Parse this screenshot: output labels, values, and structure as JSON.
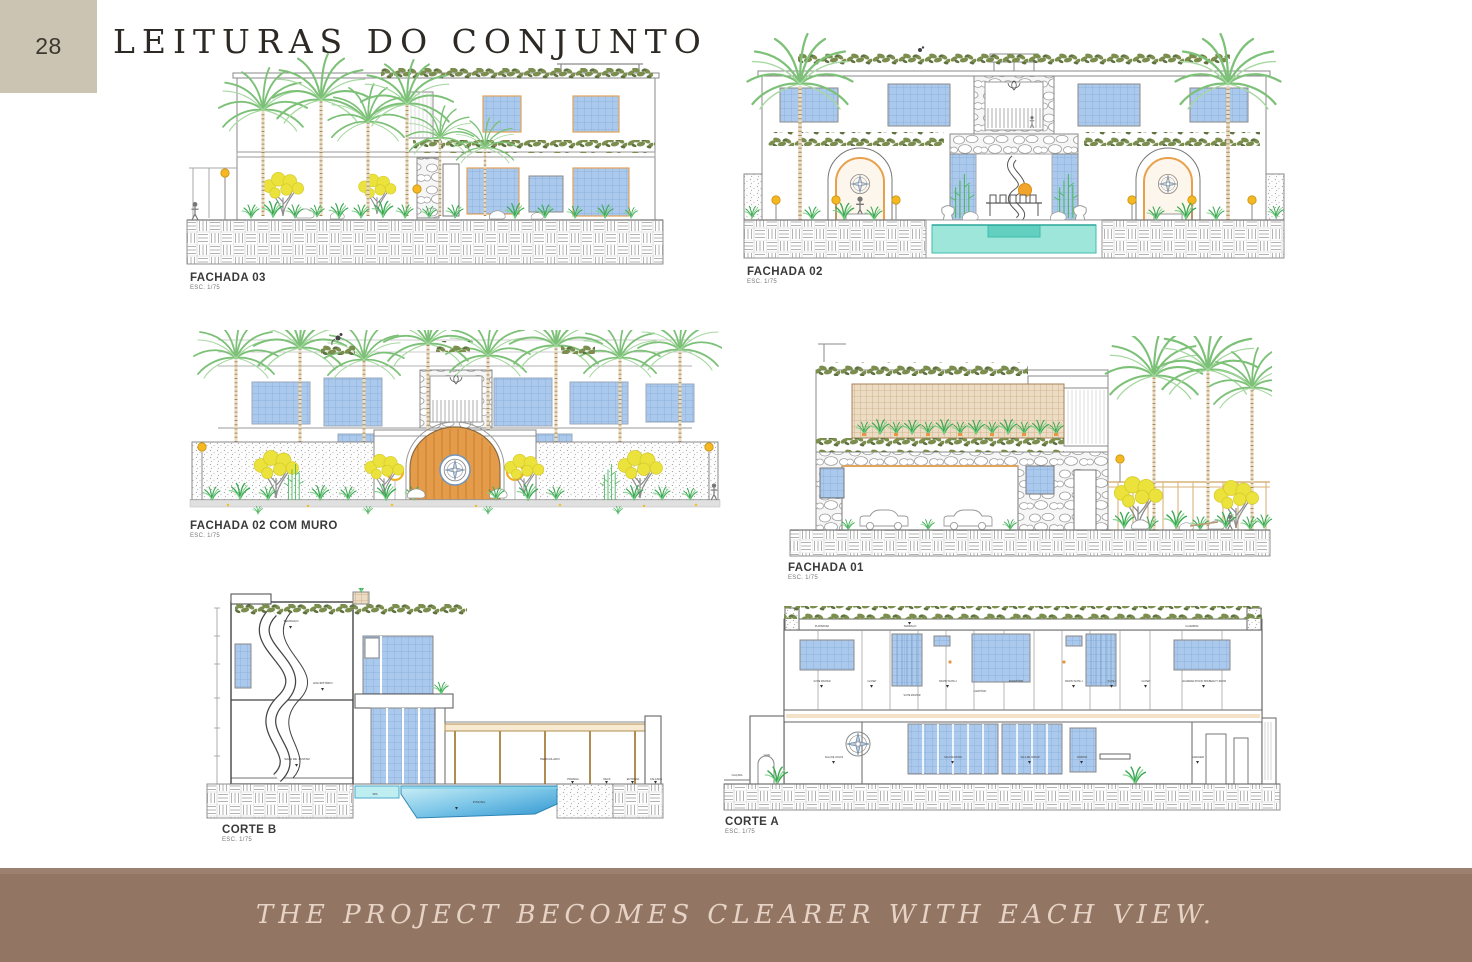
{
  "page": {
    "number": "28",
    "title": "LEITURAS DO CONJUNTO",
    "footer": "THE PROJECT BECOMES CLEARER WITH EACH VIEW."
  },
  "colors": {
    "number_box": "#cbc4b2",
    "footer_bg": "#927663",
    "footer_text": "#e7d3c5",
    "palm_green": "#7cc177",
    "garland_olive": "#7b8e4e",
    "window_blue": "#abc9ec",
    "pool_teal": "#9fe6da",
    "wood_door": "#e59c4a",
    "lamp_yellow": "#f5b823"
  },
  "drawings": {
    "fachada03": {
      "label": "FACHADA 03",
      "scale": "ESC. 1/75"
    },
    "fachada02": {
      "label": "FACHADA 02",
      "scale": "ESC. 1/75"
    },
    "fachada02_muro": {
      "label": "FACHADA 02 COM MURO",
      "scale": "ESC. 1/75"
    },
    "fachada01": {
      "label": "FACHADA 01",
      "scale": "ESC. 1/75"
    },
    "corte_b": {
      "label": "CORTE B",
      "scale": "ESC. 1/75",
      "rooms": {
        "terraco": "TERRAÇO",
        "escritorio": "ESCRITÓRIO",
        "sala_jantar": "SALA DE JANTAR",
        "pergolado": "PERGOLADO",
        "piscina": "PISCINA",
        "spa": "SPA",
        "prainha": "PRAINHA",
        "deck": "DECK",
        "entrada": "ENTRADA",
        "calcada": "CALÇADA"
      }
    },
    "corte_a": {
      "label": "CORTE A",
      "scale": "ESC. 1/75",
      "top": {
        "platibanda": "PLATIBANDA",
        "terraco": "TERRAÇO",
        "claraboia": "CLARABOIA"
      },
      "upper": {
        "suite_master": "SUITE MASTER",
        "closet": "CLOSET",
        "suite_master2": "SUITE MASTER",
        "banho_suite2": "BANHO SUITE 2",
        "lavatorio": "LAVATÓRIO",
        "escritorio": "ESCRITÓRIO",
        "banho_suite1": "BANHO SUITE 1",
        "suite1": "SUITE 1",
        "closet2": "CLOSET",
        "academia": "ACADEMIA STUDIO SPA/BEAUTY ROOM"
      },
      "lower": {
        "calcada": "CALÇADA",
        "canil": "CANIL",
        "sala_jogos": "SALA DE JOGOS",
        "sala_estar": "SALA DE ESTAR",
        "sala_jantar": "SALA DE JANTAR",
        "cozinha": "COZINHA",
        "garagem": "GARAGEM"
      }
    }
  }
}
